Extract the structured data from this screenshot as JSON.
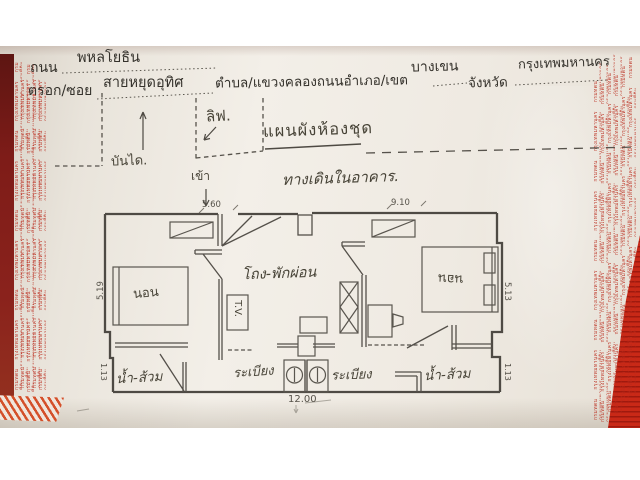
{
  "photo": {
    "form": {
      "road_label": "ถนน",
      "road_value": "พหลโยธิน",
      "soi_label": "ตรอก/ซอย",
      "soi_value": "สายหยุดอุทิศ",
      "subdistrict_label": "ตำบล/แขวง",
      "subdistrict_value": "คลองถนน",
      "district_label": "อำเภอ/เขต",
      "district_value": "บางเขน",
      "province_label": "จังหวัด",
      "province_value": "กรุงเทพมหานคร"
    },
    "plan": {
      "title": "แผนผังห้องชุด",
      "corridor_label": "ทางเดินในอาคาร.",
      "lift_label": "ลิฟ.",
      "stairs_label": "บันได.",
      "enter_label": "เข้า",
      "rooms": {
        "living_hall": "โถง-พักผ่อน",
        "bedroom_left": "นอน",
        "bedroom_right": "นอน",
        "bath_left": "น้ำ-ส้วม",
        "bath_right": "น้ำ-ส้วม",
        "balcony_left": "ระเบียง",
        "balcony_right": "ระเบียง",
        "tv_cabinet": "T.V."
      },
      "dimensions": {
        "top_left": "5.60",
        "top_right": "9.10",
        "side_left": "5.19",
        "side_right": "5.13",
        "bottom_width": "12.00",
        "bottom_left": "1.13",
        "bottom_right": "1.13"
      }
    },
    "watermark_text_illegible": "กรมที่ดิน กรุงเทพมหานคร กรมที่ดิน กรุงเทพมหานคร กรมที่ดิน กรุงเทพมหานคร กรมที่ดิน กรุงเทพมหานคร กรมที่ดิน กรุงเทพมหานคร กรมที่ดิน กรุงเทพมหานคร กรมที่ดิน กรุงเทพมหานคร กรมที่ดิน กรุงเทพมหานคร กรมที่ดิน กรุงเทพมหานคร กรมที่ดิน กรุงเทพมหานคร",
    "colors": {
      "paper": "#efeae2",
      "typed_ink": "#34312b",
      "pencil": "#514c45",
      "watermark_red": "#bb2a1c",
      "desk_red": "#c92917",
      "desk_maroon": "#7e1c18",
      "stripe_orange": "#d4502a"
    }
  }
}
